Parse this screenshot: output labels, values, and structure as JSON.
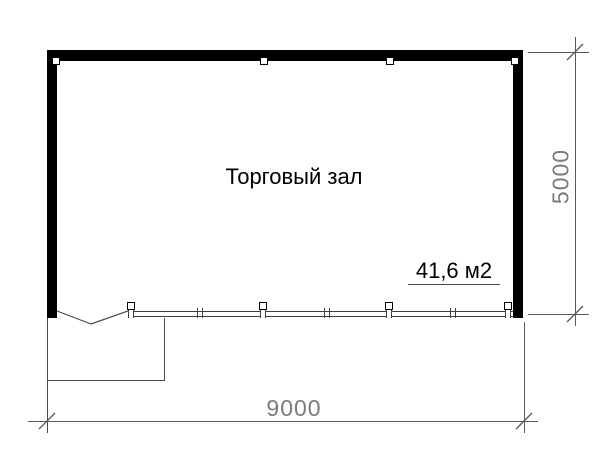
{
  "plan": {
    "room": {
      "label": "Торговый зал",
      "area": "41,6 м2"
    },
    "dimensions": {
      "width": "9000",
      "height": "5000"
    },
    "colors": {
      "wall": "#000000",
      "thin_line": "#3f3f3f",
      "dimension_line": "#5a5a5a",
      "dimension_text": "#7b7b7b",
      "label_text": "#000000",
      "background": "#ffffff"
    }
  }
}
